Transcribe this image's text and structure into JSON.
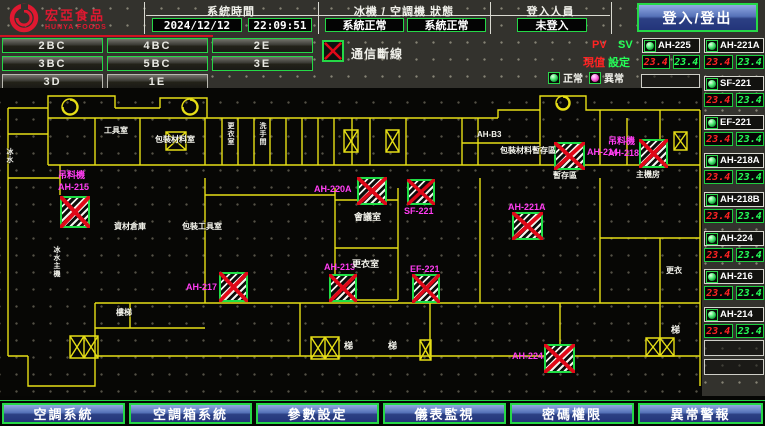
{
  "header": {
    "logo_title": "宏亞食品",
    "logo_subtitle": "HUNYA FOODS",
    "system_time_label": "系統時間",
    "date": "2024/12/12",
    "time": "22:09:51",
    "machine_status_label": "冰機 / 空調機 狀態",
    "chiller_status": "系統正常",
    "ahu_status": "系統正常",
    "login_label": "登入人員",
    "login_state": "未登入",
    "login_button": "登入/登出"
  },
  "floor_buttons": [
    "2BC",
    "4BC",
    "2E",
    "3BC",
    "5BC",
    "3E",
    "3D",
    "1E"
  ],
  "legend": {
    "comm_error": "通信斷線",
    "pv": "PV",
    "sv": "SV",
    "pv_cn": "現值",
    "sv_cn": "設定",
    "normal": "正常",
    "abnormal": "異常"
  },
  "units": {
    "featured": {
      "name": "AH-225",
      "pv": "23.4",
      "sv": "23.4"
    },
    "list": [
      {
        "name": "AH-221A",
        "pv": "23.4",
        "sv": "23.4"
      },
      {
        "name": "SF-221",
        "pv": "23.4",
        "sv": "23.4"
      },
      {
        "name": "EF-221",
        "pv": "23.4",
        "sv": "23.4"
      },
      {
        "name": "AH-218A",
        "pv": "23.4",
        "sv": "23.4"
      },
      {
        "name": "AH-218B",
        "pv": "23.4",
        "sv": "23.4"
      },
      {
        "name": "AH-224",
        "pv": "23.4",
        "sv": "23.4"
      },
      {
        "name": "AH-216",
        "pv": "23.4",
        "sv": "23.4"
      },
      {
        "name": "AH-214",
        "pv": "23.4",
        "sv": "23.4"
      }
    ]
  },
  "plan": {
    "equipment": [
      {
        "tag": "吊料機",
        "name": "AH-215"
      },
      {
        "name": "AH-220A"
      },
      {
        "name": "SF-221"
      },
      {
        "name": "AH-213"
      },
      {
        "name": "EF-221"
      },
      {
        "name": "AH-217"
      },
      {
        "name": "AH-214"
      },
      {
        "tag": "吊料機",
        "name": "AH-218"
      },
      {
        "name": "AH-221A"
      },
      {
        "name": "AH-224"
      }
    ],
    "rooms": [
      {
        "label": "工具室"
      },
      {
        "label": "包裝材料室"
      },
      {
        "label": "AH-B3"
      },
      {
        "label": "包裝材料暫存區"
      },
      {
        "label": "會議室"
      },
      {
        "label": "更衣室"
      },
      {
        "label": "資材倉庫"
      },
      {
        "label": "包裝工具室"
      },
      {
        "label": "冰水主機"
      },
      {
        "label": "樓梯"
      },
      {
        "label": "梯"
      },
      {
        "label": "梯"
      },
      {
        "label": "更衣"
      },
      {
        "label": "梯"
      },
      {
        "label": "主機房"
      },
      {
        "label": "暫存區"
      },
      {
        "label": "更衣室"
      },
      {
        "label": "洗手間"
      },
      {
        "label": "冰水"
      }
    ]
  },
  "nav": [
    "空調系統",
    "空調箱系統",
    "參數設定",
    "儀表監視",
    "密碼權限",
    "異常警報"
  ]
}
